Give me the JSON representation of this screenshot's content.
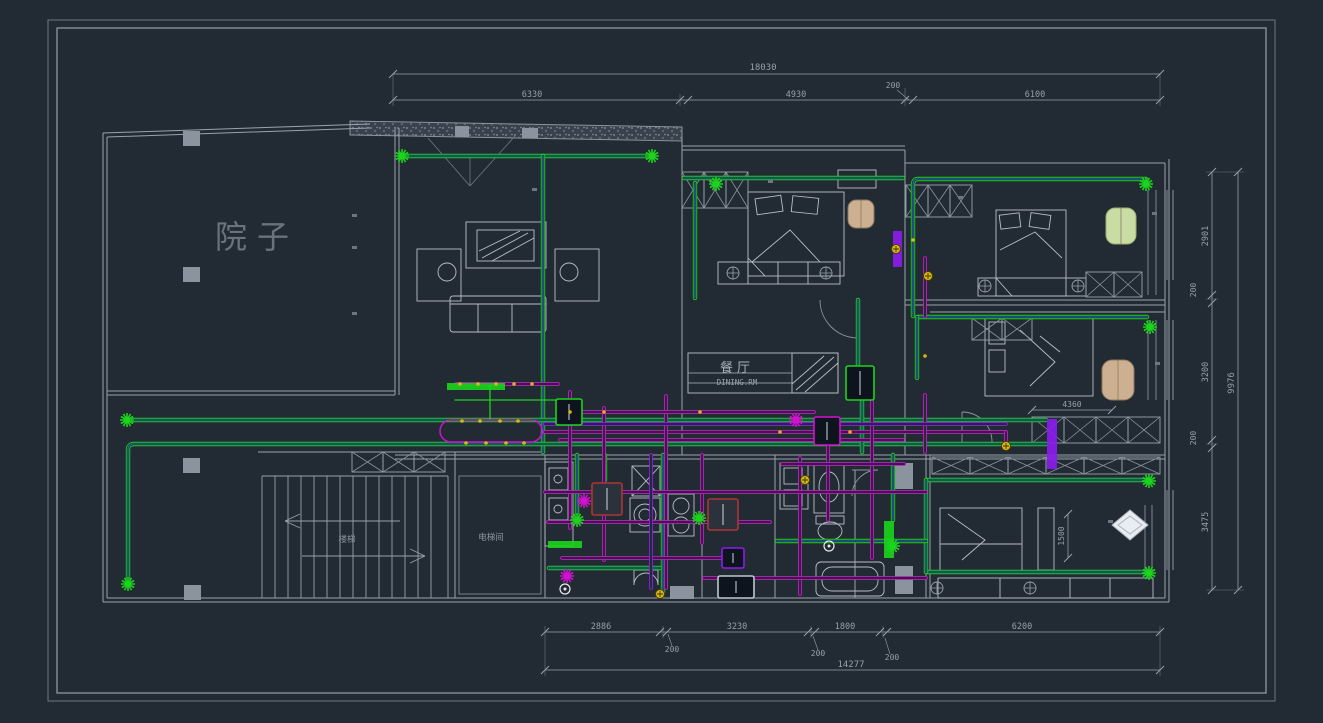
{
  "colors": {
    "background": "#222a33",
    "frame_outer": "#6f7781",
    "frame_inner": "#98a1ab",
    "wall": "#9aa2ac",
    "furniture": "#b8bfc8",
    "dim": "#97a0aa",
    "room_text": "#7d8792",
    "conduit_green": "#1bd41b",
    "conduit_blue": "#1a6fb5",
    "conduit_magenta": "#d211d2",
    "conduit_purple": "#8d1cf0",
    "marker_yellow": "#d9b90f",
    "box_red": "#b03434",
    "chair_tan": "#cdb091",
    "chair_green": "#c9dca4",
    "column": "#8b949e"
  },
  "labels": {
    "courtyard": "院子",
    "dining_cn": "餐厅",
    "dining_en": "DINING.RM",
    "stairs": "楼梯",
    "elevator": "电梯间"
  },
  "dimensions": {
    "top_total": "18030",
    "top_seg_1": "6330",
    "top_seg_2": "4930",
    "top_seg_200": "200",
    "top_seg_3": "6100",
    "bottom_seg_1": "2886",
    "bottom_200a": "200",
    "bottom_seg_2": "3230",
    "bottom_200b": "200",
    "bottom_seg_3": "1800",
    "bottom_200c": "200",
    "bottom_seg_4": "6200",
    "bottom_total": "14277",
    "right_seg_1": "2901",
    "right_200a": "200",
    "right_seg_2": "3200",
    "right_200b": "200",
    "right_seg_3": "3475",
    "right_total": "9976",
    "bed3_width": "4360",
    "closet_depth": "1500"
  }
}
